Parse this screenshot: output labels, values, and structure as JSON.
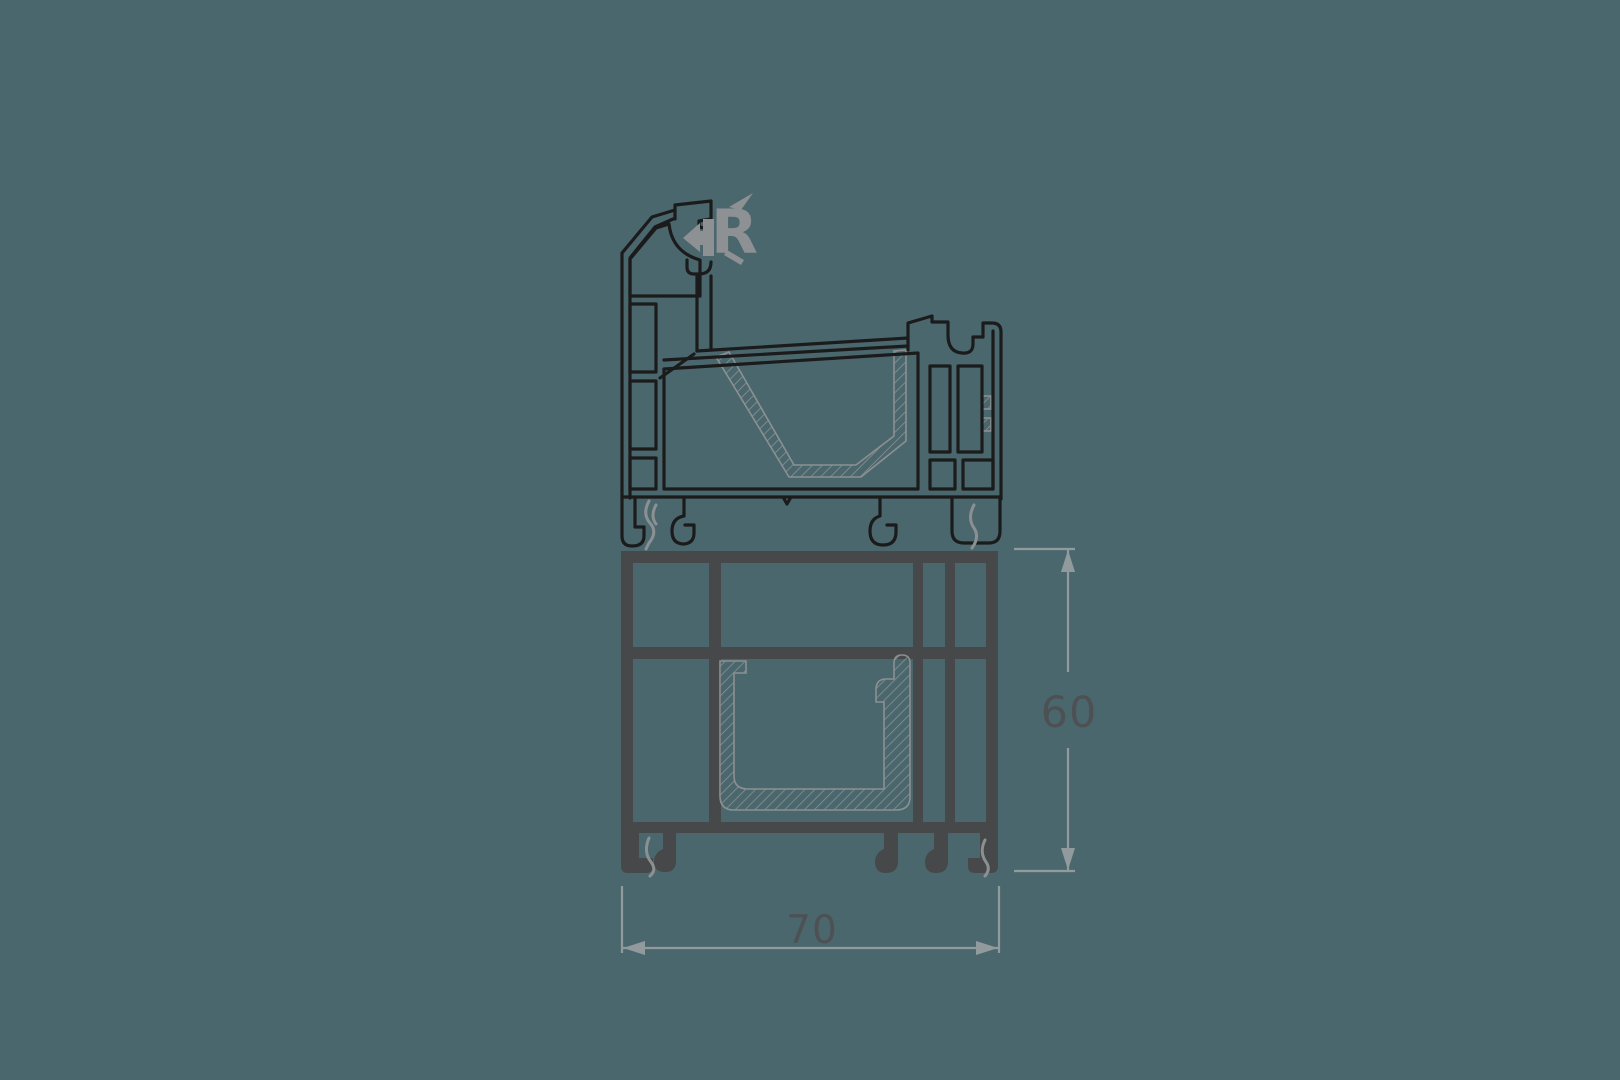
{
  "drawing": {
    "name": "window-profile-cross-section",
    "logo_letter": "R",
    "dimensions": {
      "height": {
        "label": "60",
        "orientation": "vertical"
      },
      "width": {
        "label": "70",
        "orientation": "horizontal"
      }
    }
  },
  "colors": {
    "background": "#4b676e",
    "sash_line": "#1b1b1c",
    "frame_fill": "#464849",
    "steel_line": "#8b9092",
    "gasket_line": "#8b9092",
    "dimension_line": "#919a9c",
    "dimension_text": "#4d5154",
    "logo": "#8d9193"
  }
}
